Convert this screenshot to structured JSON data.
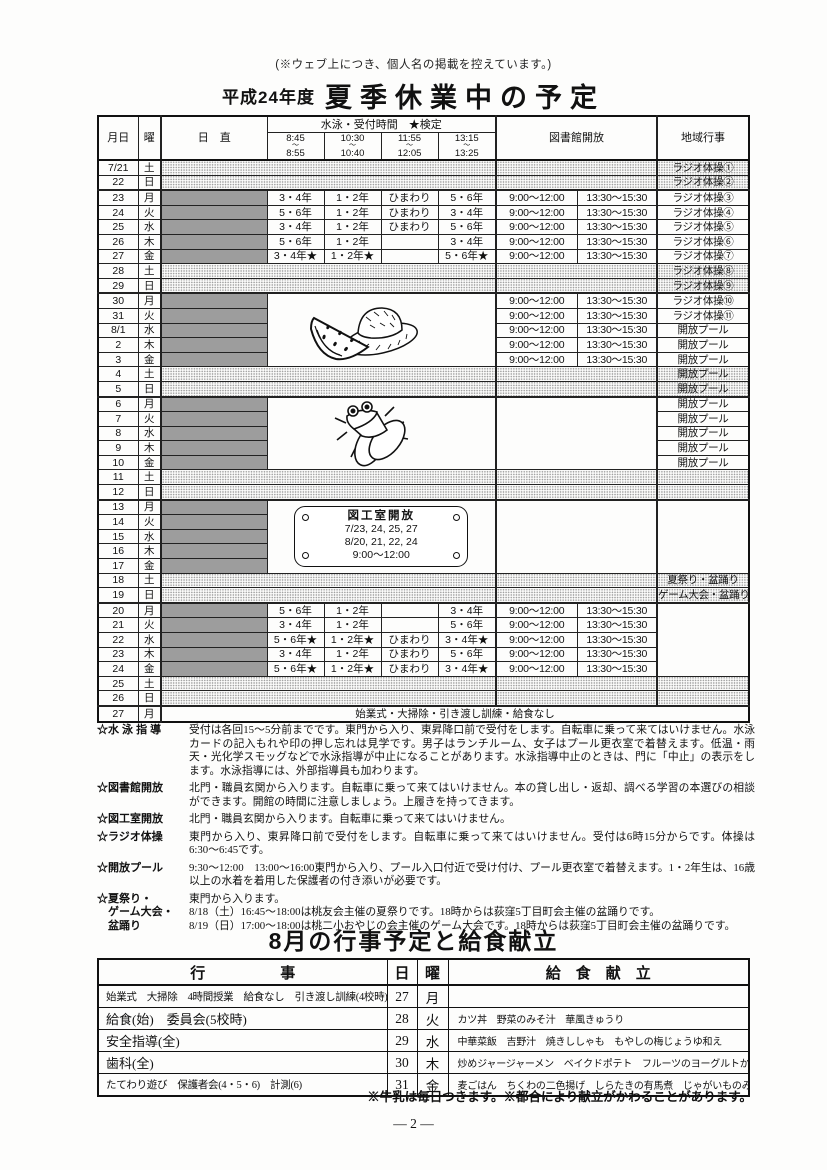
{
  "page": {
    "top_note": "(※ウェブ上につき、個人名の掲載を控えています。)",
    "title_prefix": "平成24年度",
    "title_main": "夏季休業中の予定",
    "page_number": "― 2 ―"
  },
  "colors": {
    "duty_fill": "#9d9d9d",
    "weekend_hatch": "#9b9b9b",
    "ink": "#111111"
  },
  "schedule": {
    "headers": {
      "date": "月日",
      "dow": "曜",
      "duty": "日　直",
      "swim": "水泳・受付時間　★検定",
      "library": "図書館開放",
      "region": "地域行事",
      "times": [
        [
          "8:45",
          "8:55"
        ],
        [
          "10:30",
          "10:40"
        ],
        [
          "11:55",
          "12:05"
        ],
        [
          "13:15",
          "13:25"
        ]
      ],
      "tilde": "〜"
    },
    "library_times": [
      "9:00〜12:00",
      "13:30〜15:30"
    ],
    "craft_sign": {
      "title": "図工室開放",
      "lines": [
        "7/23, 24, 25, 27",
        "8/20, 21, 22, 24",
        "9:00〜12:00"
      ]
    },
    "rows": [
      {
        "date": "7/21",
        "dow": "土",
        "kind": "weekend",
        "region": "ラジオ体操①"
      },
      {
        "date": "22",
        "dow": "日",
        "kind": "weekend",
        "region": "ラジオ体操②",
        "sep": true
      },
      {
        "date": "23",
        "dow": "月",
        "kind": "grades",
        "swim": [
          "3・4年",
          "1・2年",
          "ひまわり",
          "5・6年"
        ],
        "lib": true,
        "region": "ラジオ体操③"
      },
      {
        "date": "24",
        "dow": "火",
        "kind": "grades",
        "swim": [
          "5・6年",
          "1・2年",
          "ひまわり",
          "3・4年"
        ],
        "lib": true,
        "region": "ラジオ体操④"
      },
      {
        "date": "25",
        "dow": "水",
        "kind": "grades",
        "swim": [
          "3・4年",
          "1・2年",
          "ひまわり",
          "5・6年"
        ],
        "lib": true,
        "region": "ラジオ体操⑤"
      },
      {
        "date": "26",
        "dow": "木",
        "kind": "grades",
        "swim": [
          "5・6年",
          "1・2年",
          "",
          "3・4年"
        ],
        "lib": true,
        "region": "ラジオ体操⑥"
      },
      {
        "date": "27",
        "dow": "金",
        "kind": "grades",
        "swim": [
          "3・4年★",
          "1・2年★",
          "",
          "5・6年★"
        ],
        "lib": true,
        "region": "ラジオ体操⑦"
      },
      {
        "date": "28",
        "dow": "土",
        "kind": "weekend",
        "region": "ラジオ体操⑧"
      },
      {
        "date": "29",
        "dow": "日",
        "kind": "weekend",
        "region": "ラジオ体操⑨",
        "sep": true
      },
      {
        "date": "30",
        "dow": "月",
        "kind": "grades",
        "art": {
          "id": "summer",
          "rows": 5
        },
        "lib": true,
        "region": "ラジオ体操⑩"
      },
      {
        "date": "31",
        "dow": "火",
        "kind": "grades",
        "lib": true,
        "region": "ラジオ体操⑪"
      },
      {
        "date": "8/1",
        "dow": "水",
        "kind": "grades",
        "lib": true,
        "region": "開放プール"
      },
      {
        "date": "2",
        "dow": "木",
        "kind": "grades",
        "lib": true,
        "region": "開放プール"
      },
      {
        "date": "3",
        "dow": "金",
        "kind": "grades",
        "lib": true,
        "region": "開放プール"
      },
      {
        "date": "4",
        "dow": "土",
        "kind": "weekend",
        "region": "開放プール"
      },
      {
        "date": "5",
        "dow": "日",
        "kind": "weekend",
        "region": "開放プール",
        "sep": true
      },
      {
        "date": "6",
        "dow": "月",
        "kind": "grades",
        "art": {
          "id": "cicada",
          "rows": 5
        },
        "libblock": 5,
        "region": "開放プール"
      },
      {
        "date": "7",
        "dow": "火",
        "kind": "grades",
        "region": "開放プール"
      },
      {
        "date": "8",
        "dow": "水",
        "kind": "grades",
        "region": "開放プール"
      },
      {
        "date": "9",
        "dow": "木",
        "kind": "grades",
        "region": "開放プール"
      },
      {
        "date": "10",
        "dow": "金",
        "kind": "grades",
        "region": "開放プール"
      },
      {
        "date": "11",
        "dow": "土",
        "kind": "weekend",
        "region": ""
      },
      {
        "date": "12",
        "dow": "日",
        "kind": "weekend",
        "region": "",
        "sep": true
      },
      {
        "date": "13",
        "dow": "月",
        "kind": "grades",
        "art": {
          "id": "sign",
          "rows": 5
        },
        "libblock": 5,
        "regionblock": 5
      },
      {
        "date": "14",
        "dow": "火",
        "kind": "grades"
      },
      {
        "date": "15",
        "dow": "水",
        "kind": "grades"
      },
      {
        "date": "16",
        "dow": "木",
        "kind": "grades"
      },
      {
        "date": "17",
        "dow": "金",
        "kind": "grades"
      },
      {
        "date": "18",
        "dow": "土",
        "kind": "weekend",
        "region": "夏祭り・盆踊り"
      },
      {
        "date": "19",
        "dow": "日",
        "kind": "weekend",
        "region": "ゲーム大会・盆踊り",
        "sep": true
      },
      {
        "date": "20",
        "dow": "月",
        "kind": "grades",
        "swim": [
          "5・6年",
          "1・2年",
          "",
          "3・4年"
        ],
        "lib": true,
        "regionblock": 5
      },
      {
        "date": "21",
        "dow": "火",
        "kind": "grades",
        "swim": [
          "3・4年",
          "1・2年",
          "",
          "5・6年"
        ],
        "lib": true
      },
      {
        "date": "22",
        "dow": "水",
        "kind": "grades",
        "swim": [
          "5・6年★",
          "1・2年★",
          "ひまわり",
          "3・4年★"
        ],
        "lib": true
      },
      {
        "date": "23",
        "dow": "木",
        "kind": "grades",
        "swim": [
          "3・4年",
          "1・2年",
          "ひまわり",
          "5・6年"
        ],
        "lib": true
      },
      {
        "date": "24",
        "dow": "金",
        "kind": "grades",
        "swim": [
          "5・6年★",
          "1・2年★",
          "ひまわり",
          "3・4年★"
        ],
        "lib": true
      },
      {
        "date": "25",
        "dow": "土",
        "kind": "weekend",
        "region": ""
      },
      {
        "date": "26",
        "dow": "日",
        "kind": "weekend",
        "region": "",
        "sep": true
      },
      {
        "date": "27",
        "dow": "月",
        "kind": "span",
        "text": "始業式・大掃除・引き渡し訓練・給食なし"
      }
    ]
  },
  "notes": [
    {
      "label": "☆水 泳 指 導",
      "text": "受付は各回15〜5分前までです。東門から入り、東昇降口前で受付をします。自転車に乗って来てはいけません。水泳カードの記入もれや印の押し忘れは見学です。男子はランチルーム、女子はプール更衣室で着替えます。低温・雨天・光化学スモッグなどで水泳指導が中止になることがあります。水泳指導中止のときは、門に「中止」の表示をします。水泳指導には、外部指導員も加わります。"
    },
    {
      "label": "☆図書館開放",
      "text": "北門・職員玄関から入ります。自転車に乗って来てはいけません。本の貸し出し・返却、調べる学習の本選びの相談ができます。開館の時間に注意しましょう。上履きを持ってきます。"
    },
    {
      "label": "☆図工室開放",
      "text": "北門・職員玄関から入ります。自転車に乗って来てはいけません。"
    },
    {
      "label": "☆ラジオ体操",
      "text": "東門から入り、東昇降口前で受付をします。自転車に乗って来てはいけません。受付は6時15分からです。体操は6:30〜6:45です。"
    },
    {
      "label": "☆開放プール",
      "text": "9:30〜12:00　13:00〜16:00東門から入り、プール入口付近で受け付け、プール更衣室で着替えます。1・2年生は、16歳以上の水着を着用した保護者の付き添いが必要です。"
    },
    {
      "label": "☆夏祭り・\n　ゲーム大会・\n　盆踊り",
      "text": "東門から入ります。\n8/18（土）16:45〜18:00は桃友会主催の夏祭りです。18時からは荻窪5丁目町会主催の盆踊りです。\n8/19（日）17:00〜18:00は桃二小おやじの会主催のゲーム大会です。18時からは荻窪5丁目町会主催の盆踊りです。"
    }
  ],
  "august": {
    "title": "8月の行事予定と給食献立",
    "headers": {
      "event": "行　　　　　事",
      "day": "日",
      "dow": "曜",
      "menu": "給　食　献　立"
    },
    "rows": [
      {
        "event": "始業式　大掃除　4時間授業　給食なし　引き渡し訓練(4校時)",
        "day": "27",
        "dow": "月",
        "menu": ""
      },
      {
        "event": "給食(始)　委員会(5校時)",
        "day": "28",
        "dow": "火",
        "menu": "カツ丼　野菜のみそ汁　華風きゅうり"
      },
      {
        "event": "安全指導(全)",
        "day": "29",
        "dow": "水",
        "menu": "中華菜飯　吉野汁　焼きししゃも　もやしの梅じょうゆ和え"
      },
      {
        "event": "歯科(全)",
        "day": "30",
        "dow": "木",
        "menu": "炒めジャージャーメン　ベイクドポテト　フルーツのヨーグルトかけ"
      },
      {
        "event": "たてわり遊び　保護者会(4・5・6)　計測(6)",
        "day": "31",
        "dow": "金",
        "menu": "麦ごはん　ちくわの二色揚げ　しらたきの有馬煮　じゃがいものみそ汁"
      }
    ],
    "footnote": "※牛乳は毎日つきます。※都合により献立がかわることがあります。"
  }
}
